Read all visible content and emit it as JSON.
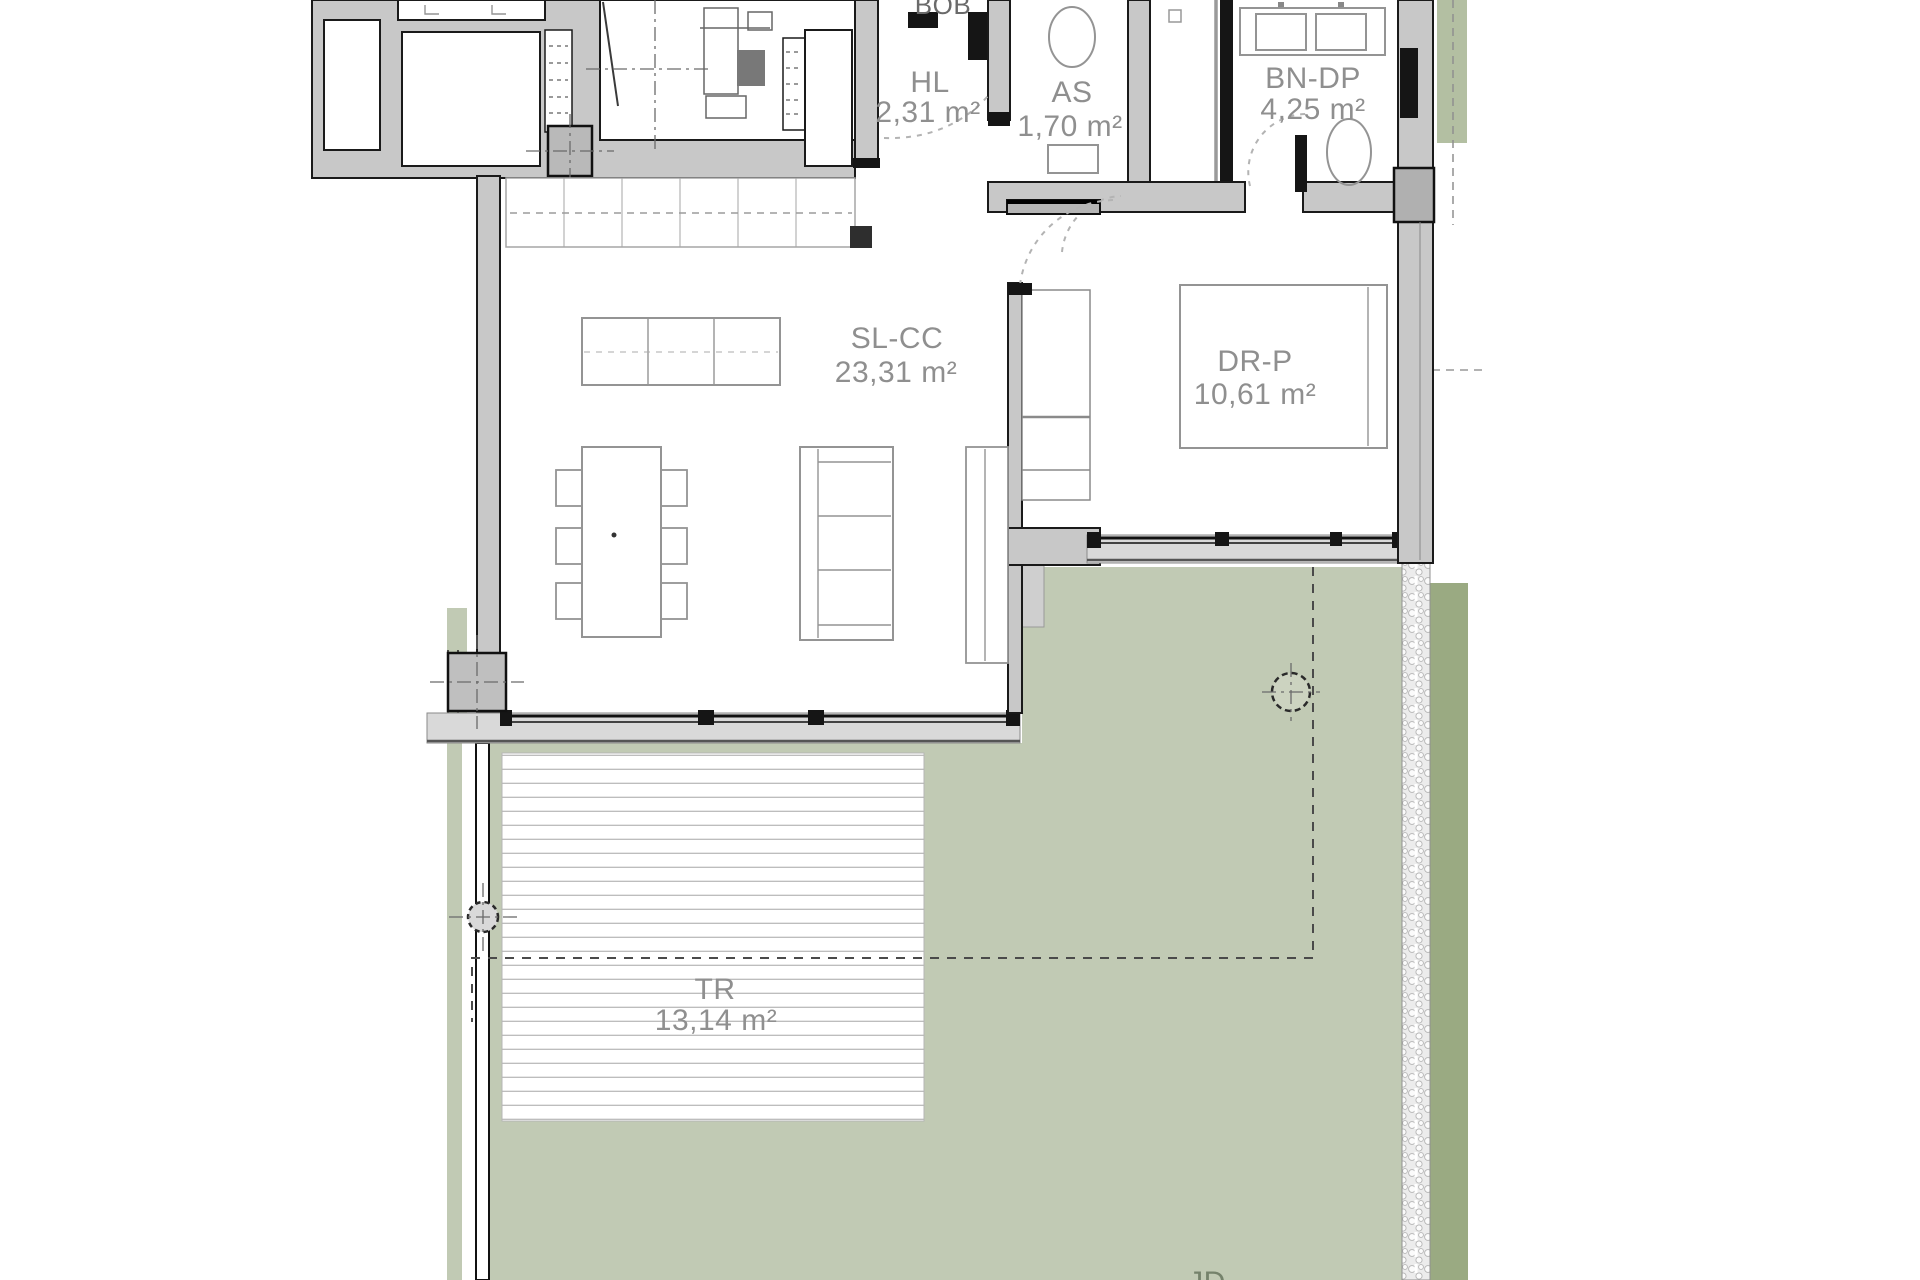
{
  "plan": {
    "title": "apartment floor plan with terrace and garden",
    "labels": {
      "bob": {
        "text": "BOB"
      },
      "hl": {
        "name": "HL",
        "area": "2,31 m²"
      },
      "as": {
        "name": "AS",
        "area": "1,70 m²"
      },
      "bn_dp": {
        "name": "BN-DP",
        "area": "4,25 m²"
      },
      "sl_cc": {
        "name": "SL-CC",
        "area": "23,31 m²"
      },
      "dr_p": {
        "name": "DR-P",
        "area": "10,61 m²"
      },
      "tr": {
        "name": "TR",
        "area": "13,14 m²"
      },
      "jd": {
        "text": "JD"
      }
    },
    "colors": {
      "terrace_green": "#c1cab4",
      "hedge_green": "#9aaa82",
      "hedge_top_green": "#b3bfa2",
      "wall_gray": "#c8c8c8",
      "furniture_gray": "#949494",
      "text_gray": "#8f8f8f",
      "deck_white": "#ffffff"
    }
  }
}
